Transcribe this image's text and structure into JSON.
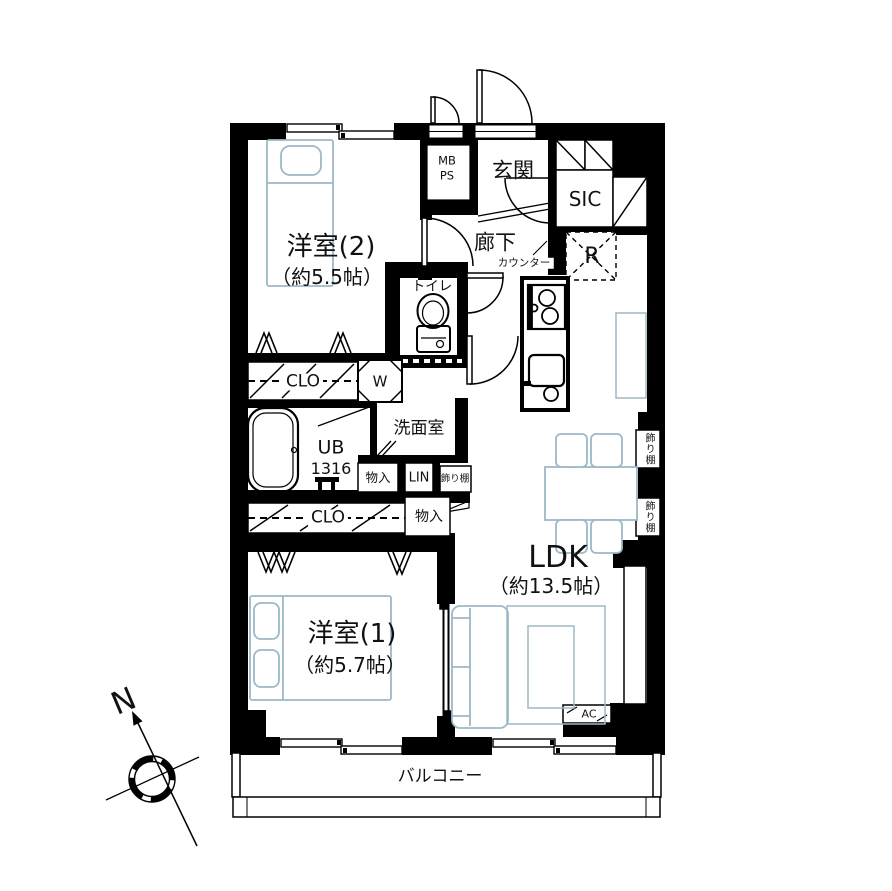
{
  "floorplan": {
    "rooms": {
      "bedroom2": {
        "name": "洋室(2)",
        "size": "（約5.5帖）"
      },
      "bedroom1": {
        "name": "洋室(1)",
        "size": "（約5.7帖）"
      },
      "ldk": {
        "name": "LDK",
        "size": "（約13.5帖）"
      },
      "entrance": {
        "label": "玄関"
      },
      "hallway": {
        "label": "廊下"
      },
      "toilet": {
        "label": "トイレ"
      },
      "washroom": {
        "label": "洗面室"
      },
      "bathroom": {
        "label": "UB",
        "size": "1316"
      },
      "shoe_closet": {
        "label": "SIC"
      },
      "balcony": {
        "label": "バルコニー"
      }
    },
    "storage": {
      "closet_upper": {
        "label": "CLO"
      },
      "closet_lower": {
        "label": "CLO"
      },
      "storage_upper": {
        "label": "物入"
      },
      "storage_lower": {
        "label": "物入"
      },
      "linen": {
        "label": "LIN"
      },
      "shelf_inner": {
        "label": "飾り棚"
      },
      "shelf_right_upper": {
        "label": "飾り棚"
      },
      "shelf_right_lower": {
        "label": "飾り棚"
      }
    },
    "equipment": {
      "meter_box": {
        "line1": "MB",
        "line2": "PS"
      },
      "refrigerator": {
        "label": "R"
      },
      "washer": {
        "label": "W"
      },
      "counter": {
        "label": "カウンター"
      },
      "air_conditioner": {
        "label": "AC"
      }
    },
    "compass": {
      "north": "N"
    },
    "colors": {
      "wall": "#000000",
      "furniture_outline": "#9db8c6",
      "text": "#111111",
      "background": "#ffffff"
    }
  }
}
